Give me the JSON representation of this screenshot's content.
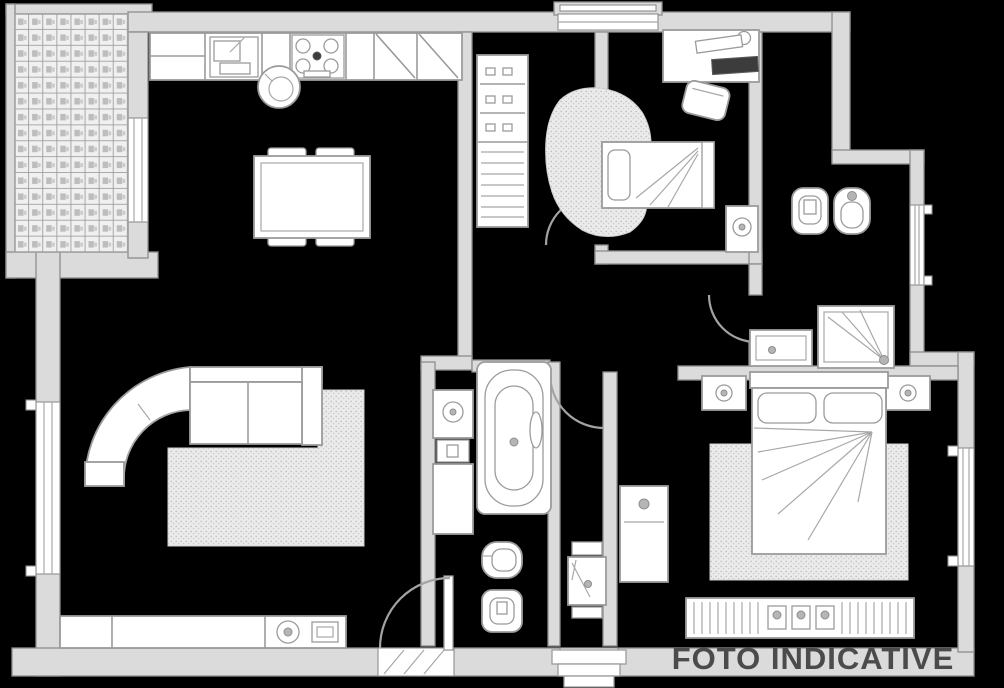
{
  "watermark": {
    "text": "FOTO INDICATIVE",
    "color": "#4b4b4b"
  },
  "palette": {
    "background": "#000000",
    "wall_fill": "#dbdbdb",
    "wall_stroke": "#8e8e8e",
    "furniture_fill": "#ffffff",
    "furniture_stroke": "#9b9b9b",
    "rug_fill": "#ebebeb",
    "dark_item": "#3c3c3c",
    "watermark_color": "#4b4b4b"
  },
  "plan": {
    "type": "apartment-floor-plan",
    "style": "grayscale blueprint on black background",
    "rooms": [
      {
        "name": "terrace",
        "features": [
          "tiled-floor",
          "parapet-walls",
          "window-to-kitchen"
        ]
      },
      {
        "name": "kitchen-dining",
        "features": [
          "kitchen-counter",
          "sink",
          "hob-4-burners",
          "tall-cabinets-diagonal",
          "dining-table",
          "four-chairs",
          "stool"
        ]
      },
      {
        "name": "living-room",
        "features": [
          "corner-sofa",
          "area-rug",
          "tv-sideboard",
          "french-door",
          "window-left"
        ]
      },
      {
        "name": "hallway",
        "features": [
          "shelving-closet",
          "wardrobe-rail",
          "skin-rug",
          "washstand-console",
          "entrance-steps",
          "interior-doors"
        ]
      },
      {
        "name": "bedroom-1",
        "features": [
          "desk",
          "office-chair",
          "single-bed",
          "flower-side-table",
          "window-top"
        ]
      },
      {
        "name": "bathroom-1",
        "features": [
          "toilet",
          "bidet",
          "shower",
          "cabinet",
          "window-right"
        ]
      },
      {
        "name": "bathroom-2",
        "features": [
          "vanity-washbasin",
          "bathtub",
          "bidet",
          "toilet"
        ]
      },
      {
        "name": "master-bedroom",
        "features": [
          "double-bed",
          "nightstand-left",
          "nightstand-right",
          "bedside-lamps",
          "area-rug",
          "cabinet",
          "radiator",
          "window-right"
        ]
      }
    ]
  }
}
